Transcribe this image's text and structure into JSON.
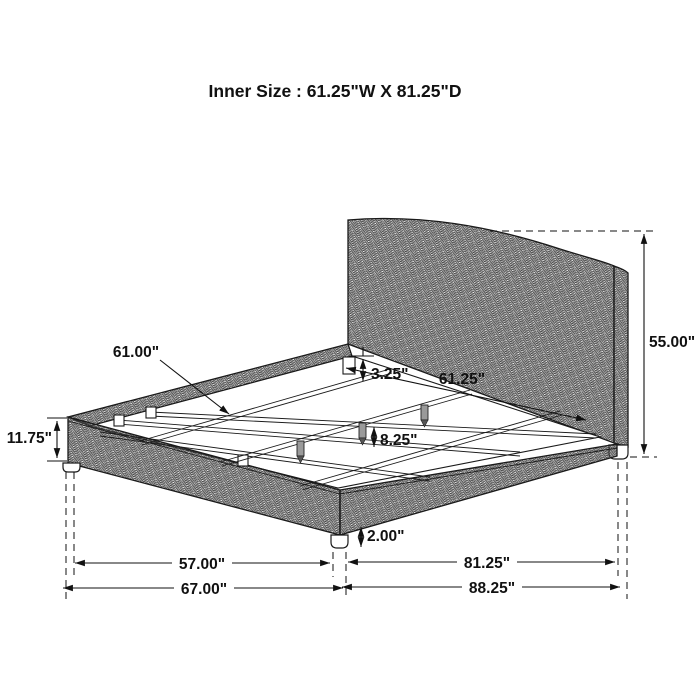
{
  "title": "Inner Size : 61.25\"W X 81.25\"D",
  "labels": {
    "slat_length": "61.00\"",
    "rail_to_slat": "3.25\"",
    "inner_width": "61.25\"",
    "slat_spacing": "8.25\"",
    "headboard_height": "55.00\"",
    "footboard_height": "11.75\"",
    "leg_height": "2.00\"",
    "front_inner_span": "57.00\"",
    "overall_width": "67.00\"",
    "inner_depth": "81.25\"",
    "overall_depth": "88.25\""
  }
}
